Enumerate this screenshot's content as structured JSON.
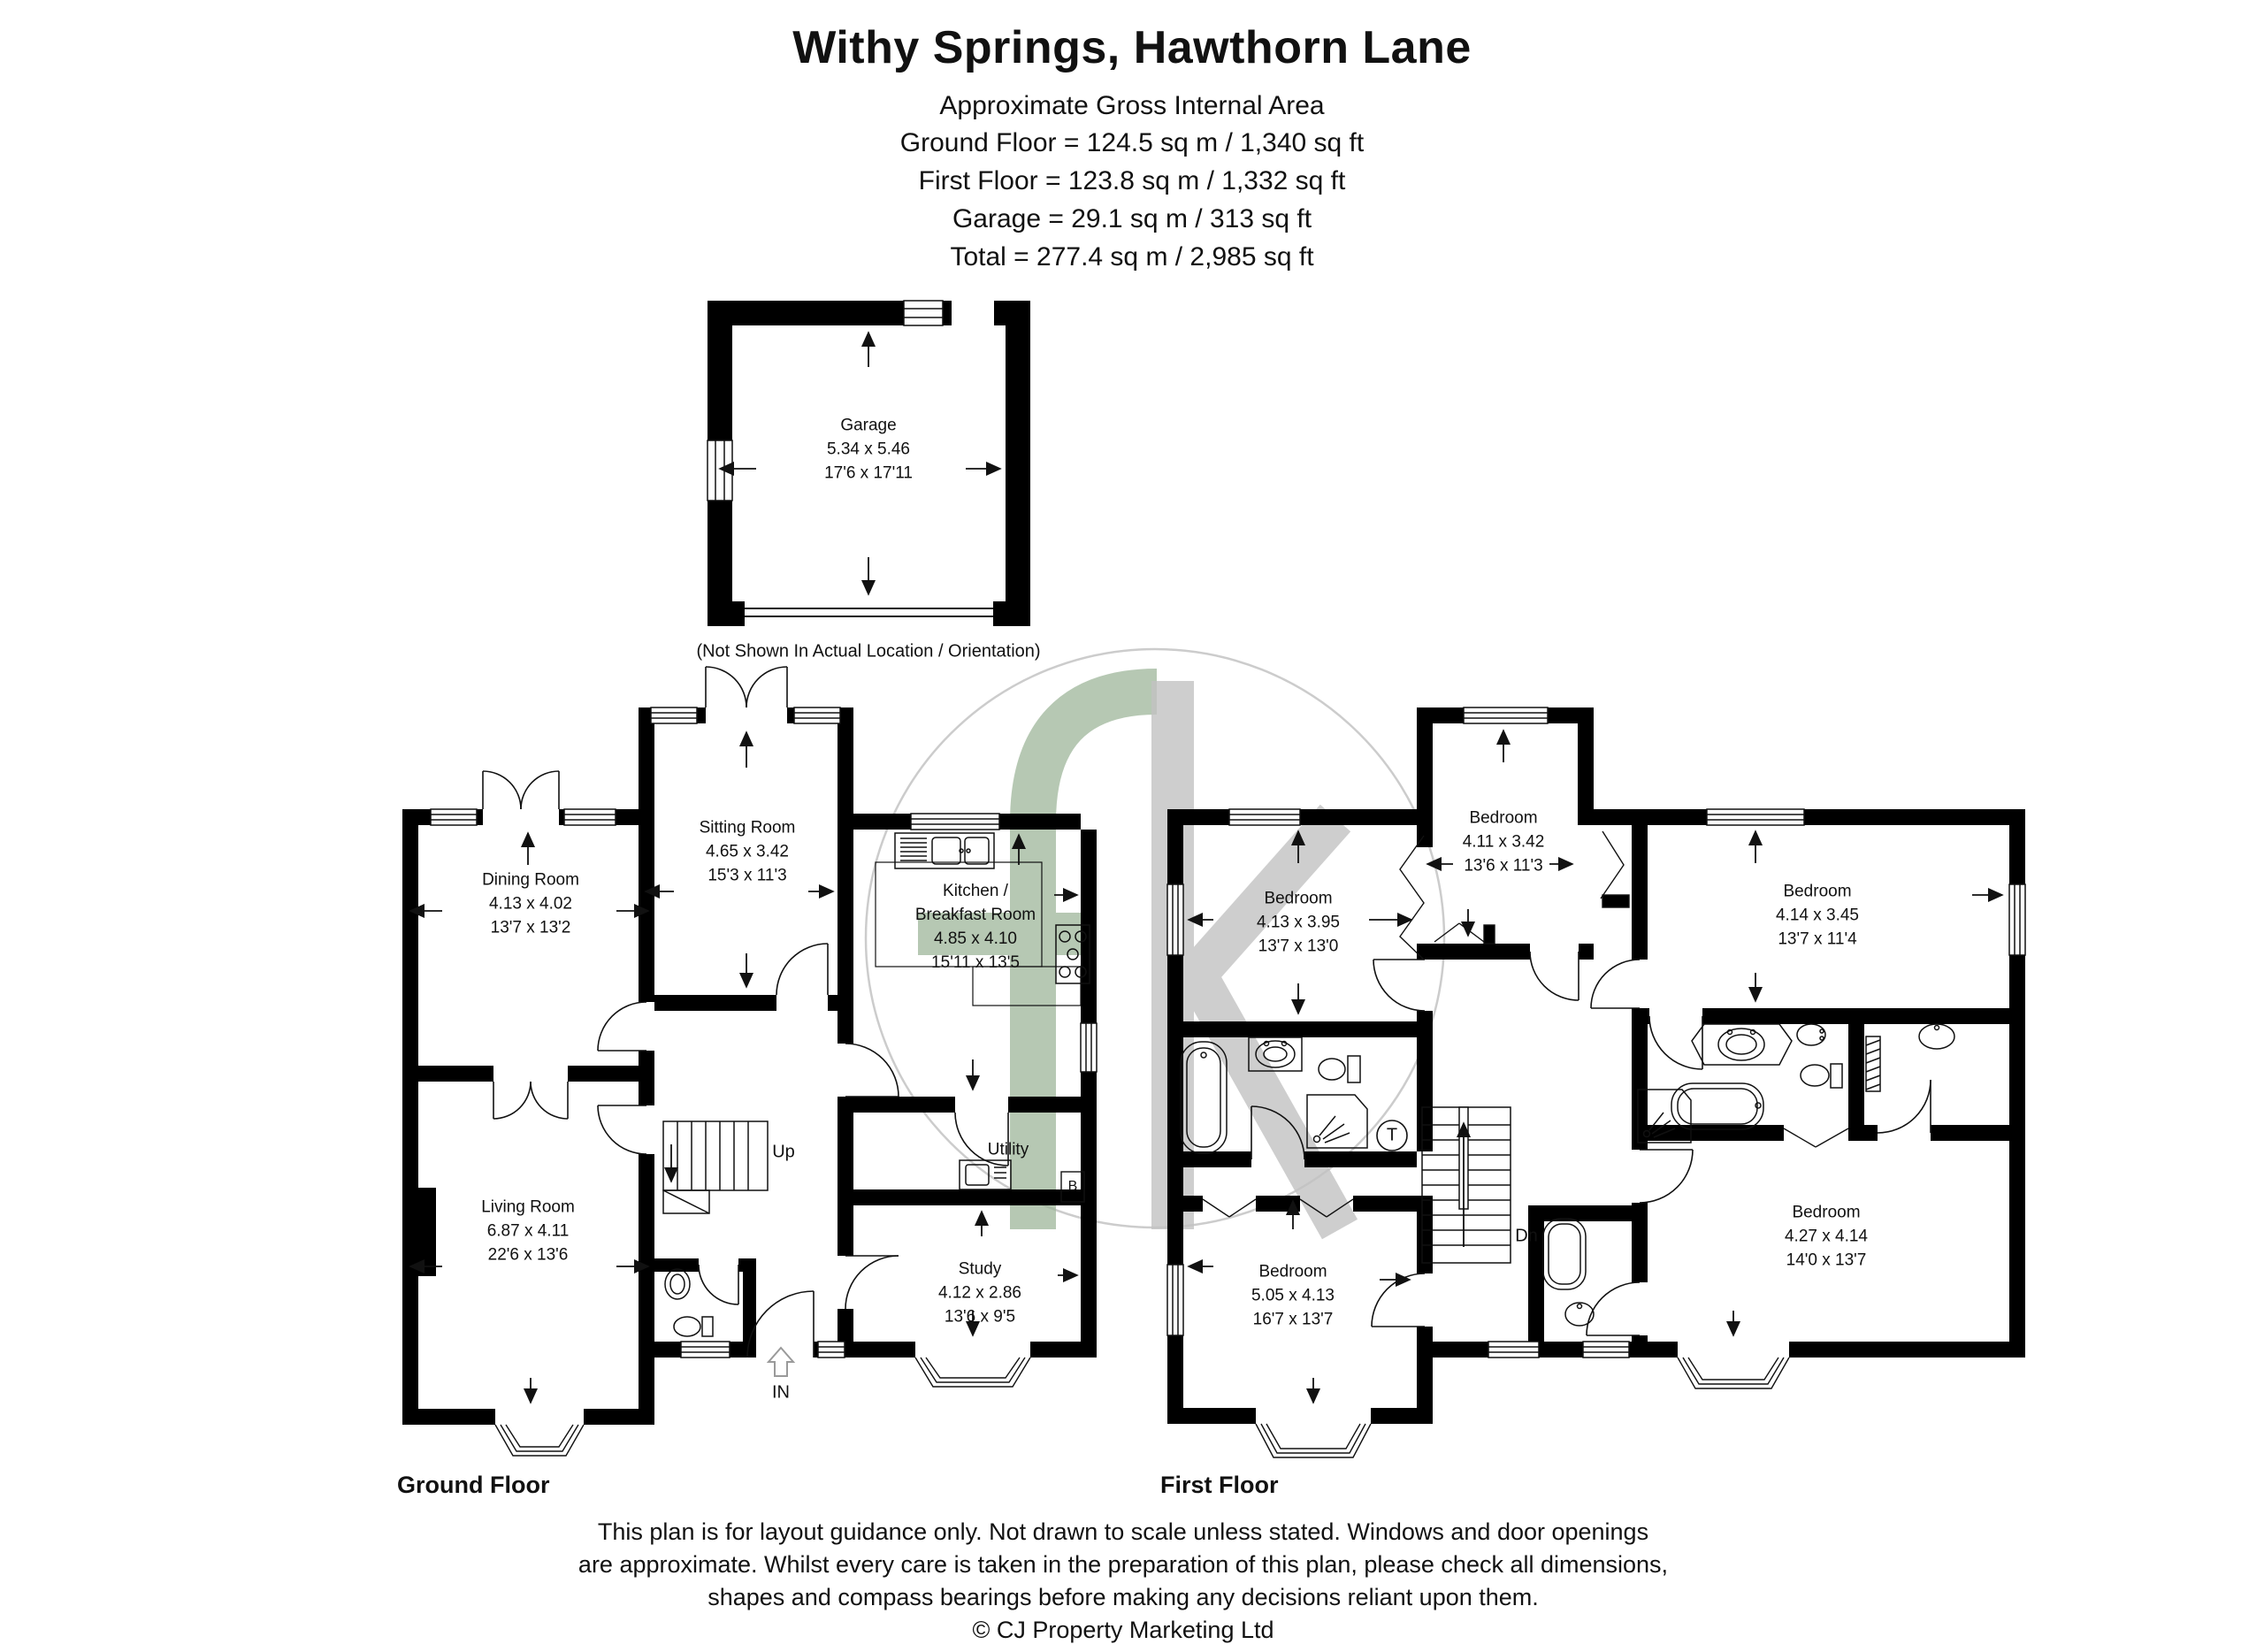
{
  "header": {
    "title": "Withy Springs, Hawthorn Lane",
    "subtitle": "Approximate Gross Internal Area",
    "areas": [
      "Ground Floor = 124.5 sq m / 1,340 sq ft",
      "First Floor = 123.8 sq m / 1,332 sq ft",
      "Garage = 29.1 sq m / 313 sq ft",
      "Total = 277.4 sq m / 2,985 sq ft"
    ]
  },
  "garage": {
    "name": "Garage",
    "metric": "5.34 x 5.46",
    "imperial": "17'6 x 17'11",
    "note": "(Not Shown In Actual Location / Orientation)"
  },
  "ground_floor": {
    "label": "Ground Floor",
    "dining": {
      "name": "Dining Room",
      "metric": "4.13 x 4.02",
      "imperial": "13'7 x 13'2"
    },
    "sitting": {
      "name": "Sitting Room",
      "metric": "4.65 x 3.42",
      "imperial": "15'3 x 11'3"
    },
    "kitchen": {
      "name_line1": "Kitchen /",
      "name_line2": "Breakfast Room",
      "metric": "4.85 x 4.10",
      "imperial": "15'11 x 13'5"
    },
    "living": {
      "name": "Living Room",
      "metric": "6.87 x 4.11",
      "imperial": "22'6 x 13'6"
    },
    "study": {
      "name": "Study",
      "metric": "4.12 x 2.86",
      "imperial": "13'6 x 9'5"
    },
    "utility_label": "Utility",
    "stairs_label": "Up",
    "entrance_label": "IN",
    "boiler_label": "B"
  },
  "first_floor": {
    "label": "First Floor",
    "bed_left": {
      "name": "Bedroom",
      "metric": "4.13 x 3.95",
      "imperial": "13'7 x 13'0"
    },
    "bed_top": {
      "name": "Bedroom",
      "metric": "4.11 x 3.42",
      "imperial": "13'6 x 11'3"
    },
    "bed_right_top": {
      "name": "Bedroom",
      "metric": "4.14 x 3.45",
      "imperial": "13'7 x 11'4"
    },
    "bed_right_bottom": {
      "name": "Bedroom",
      "metric": "4.27 x 4.14",
      "imperial": "14'0 x 13'7"
    },
    "bed_left_bottom": {
      "name": "Bedroom",
      "metric": "5.05 x 4.13",
      "imperial": "16'7 x 13'7"
    },
    "stairs_label": "Dn",
    "tank_label": "T"
  },
  "footer": {
    "line1": "This plan is for layout guidance only. Not drawn to scale unless stated. Windows and door openings",
    "line2": "are approximate. Whilst every care is taken in the preparation of this plan, please check all dimensions,",
    "line3": "shapes and compass bearings before making any decisions reliant upon them.",
    "copyright": "© CJ Property Marketing Ltd"
  },
  "watermark": {
    "circle_color": "#cccccc",
    "f_color": "#9eb69a",
    "k_color": "#c3c3c3"
  }
}
